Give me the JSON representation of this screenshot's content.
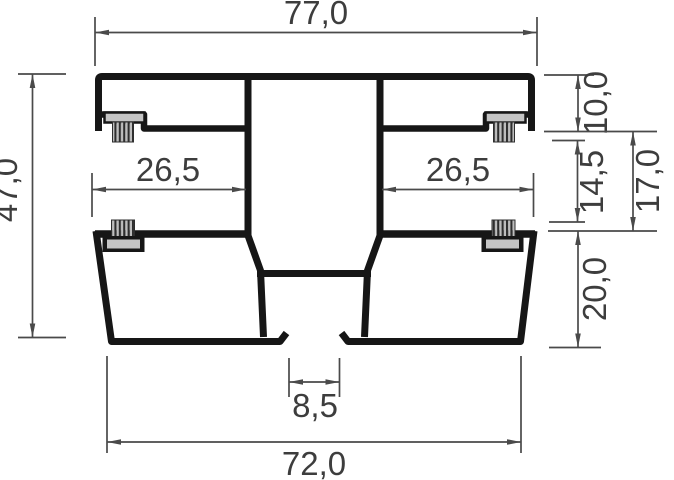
{
  "drawing": {
    "title": "aluminium profile cross-section",
    "dimensions": {
      "top_width": "77,0",
      "overall_height": "47,0",
      "pocket_left": "26,5",
      "pocket_right": "26,5",
      "flange_height": "10,0",
      "seal_gap": "14,5",
      "rebate_height": "17,0",
      "lower_chamber_height": "20,0",
      "drain_slot": "8,5",
      "bottom_width": "72,0"
    },
    "colors": {
      "profile_line": "#161616",
      "dimension_line": "#4a4a4a",
      "label_text": "#3d3d3d",
      "seal_light": "#c4c4c4",
      "seal_dark": "#2e2e2e",
      "background": "#ffffff"
    }
  }
}
